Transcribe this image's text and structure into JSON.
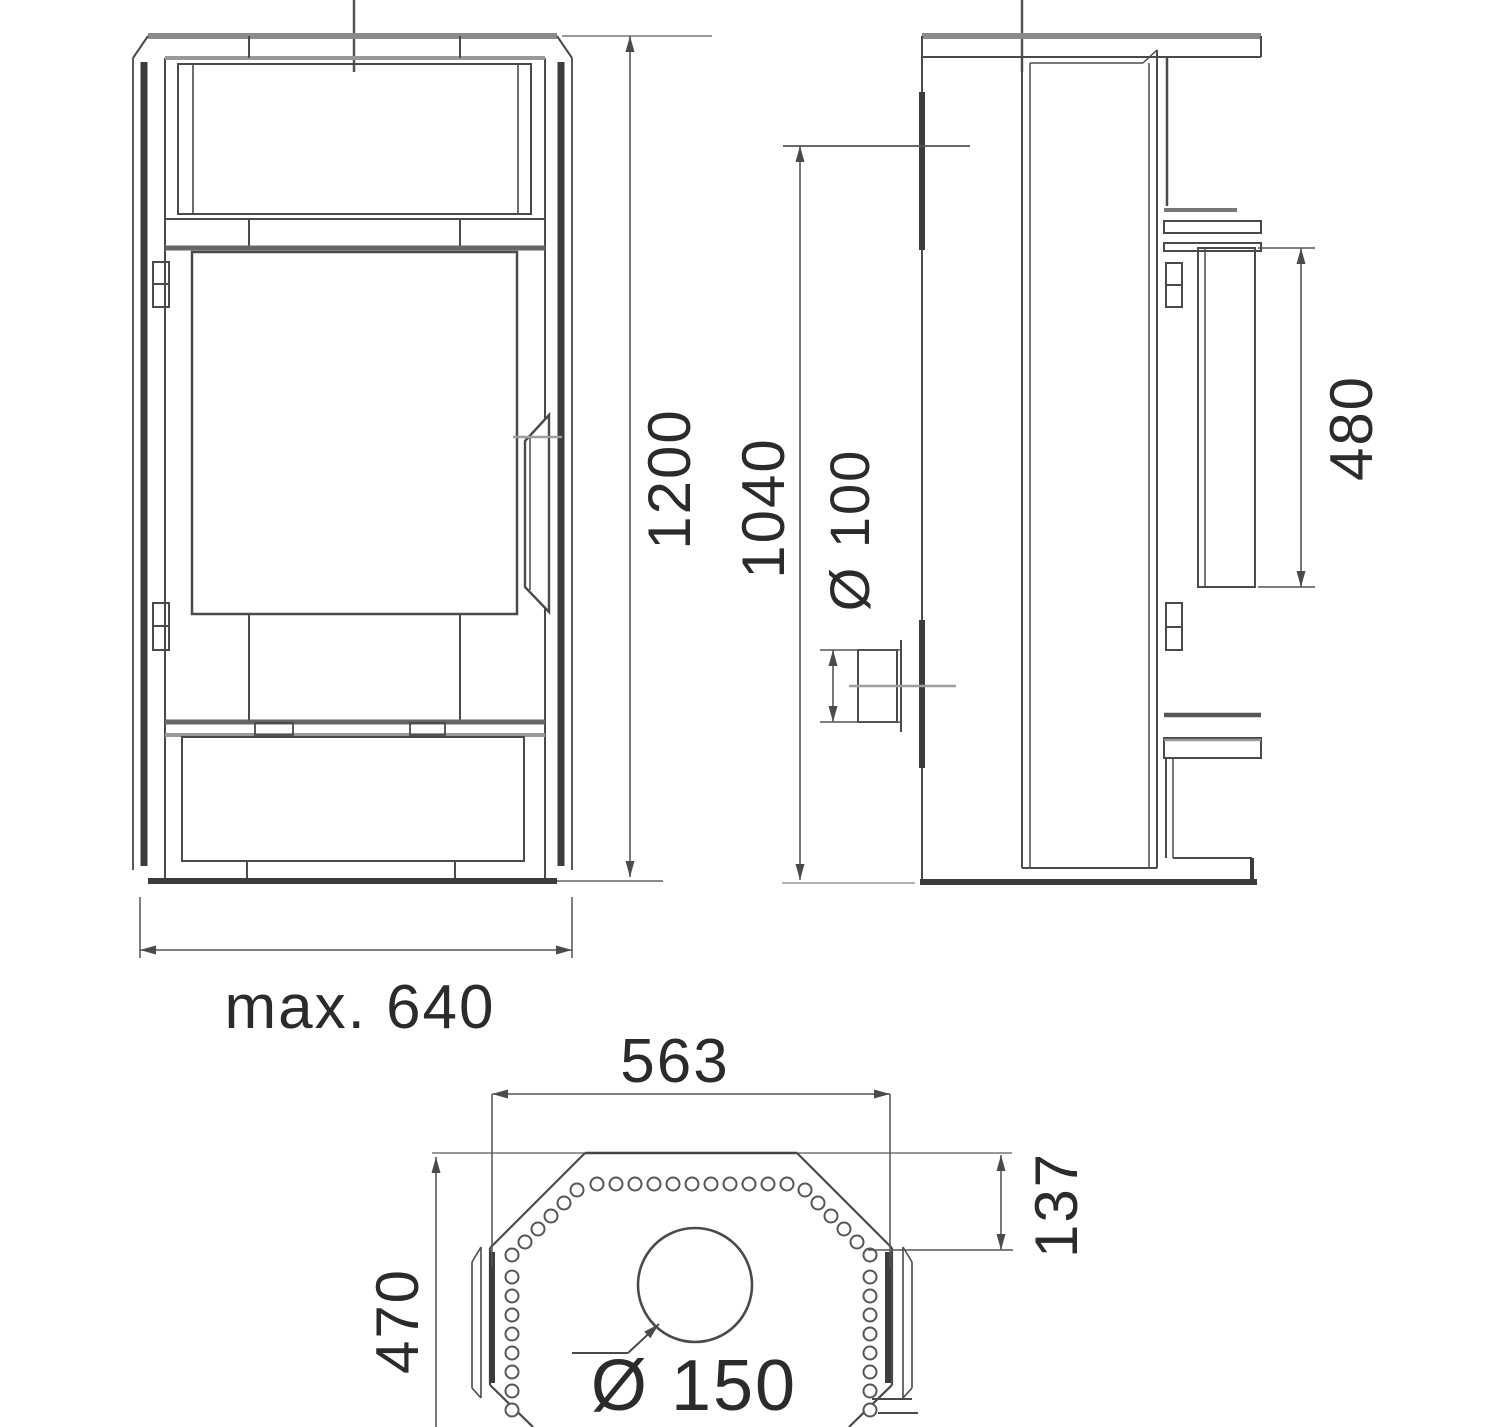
{
  "drawing": {
    "type": "technical-dimension-drawing",
    "views": {
      "front": {
        "height_label": "1200",
        "width_label": "max. 640"
      },
      "side": {
        "flue_height_label": "1040",
        "air_inlet_label": "Ø 100",
        "rear_panel_label": "480"
      },
      "top": {
        "width_label": "563",
        "depth_label": "470",
        "rear_offset_label": "137",
        "flue_diameter_label": "Ø 150"
      }
    },
    "dimensions_mm": {
      "overall_height": 1200,
      "max_width": 640,
      "flue_outlet_height": 1040,
      "air_inlet_diameter": 100,
      "rear_panel_height": 480,
      "top_width": 563,
      "top_depth": 470,
      "top_rear_offset": 137,
      "flue_diameter": 150
    },
    "colors": {
      "line_main": "#4a4a4a",
      "line_heavy_gray": "#8a8a8a",
      "line_dark_bar": "#3c3c3c",
      "background": "#ffffff"
    }
  }
}
